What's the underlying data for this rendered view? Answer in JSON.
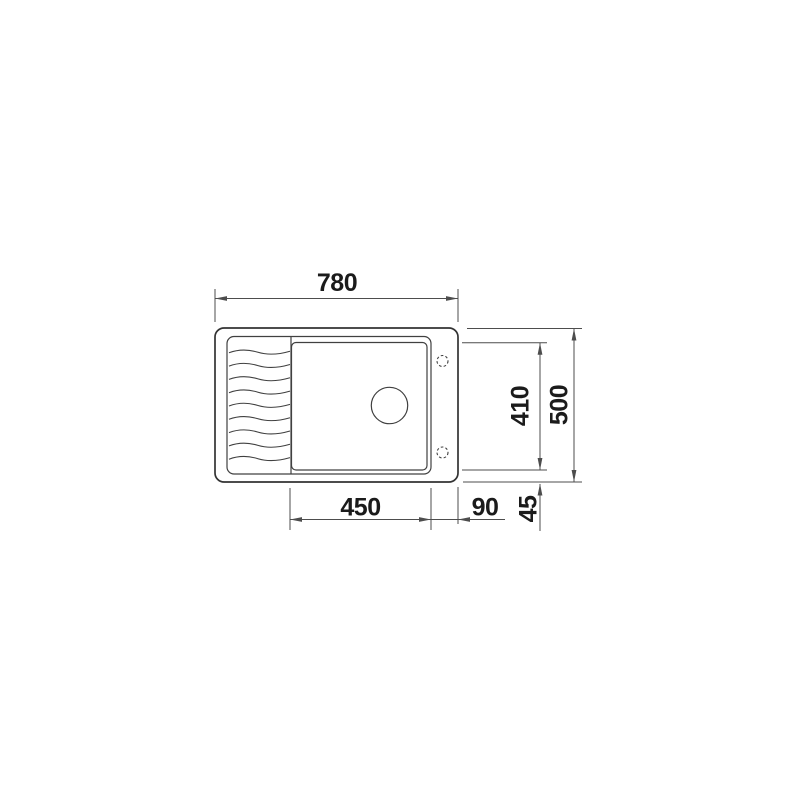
{
  "diagram": {
    "title": "Technical top-view dimension drawing of a kitchen sink with drainboard",
    "units": "mm",
    "labels": {
      "overall_width": "780",
      "overall_depth": "500",
      "bowl_inner_depth": "410",
      "bowl_width": "450",
      "right_ledge": "90",
      "rim_offset": "45"
    },
    "features": {
      "drainboard_wave_count": 9,
      "tap_hole_count": 2,
      "drain_hole_count": 1
    },
    "colors": {
      "outline": "#333333",
      "detail": "#404040",
      "dimension": "#4d4d4d",
      "text": "#1b1b1b",
      "background": "#ffffff"
    }
  }
}
